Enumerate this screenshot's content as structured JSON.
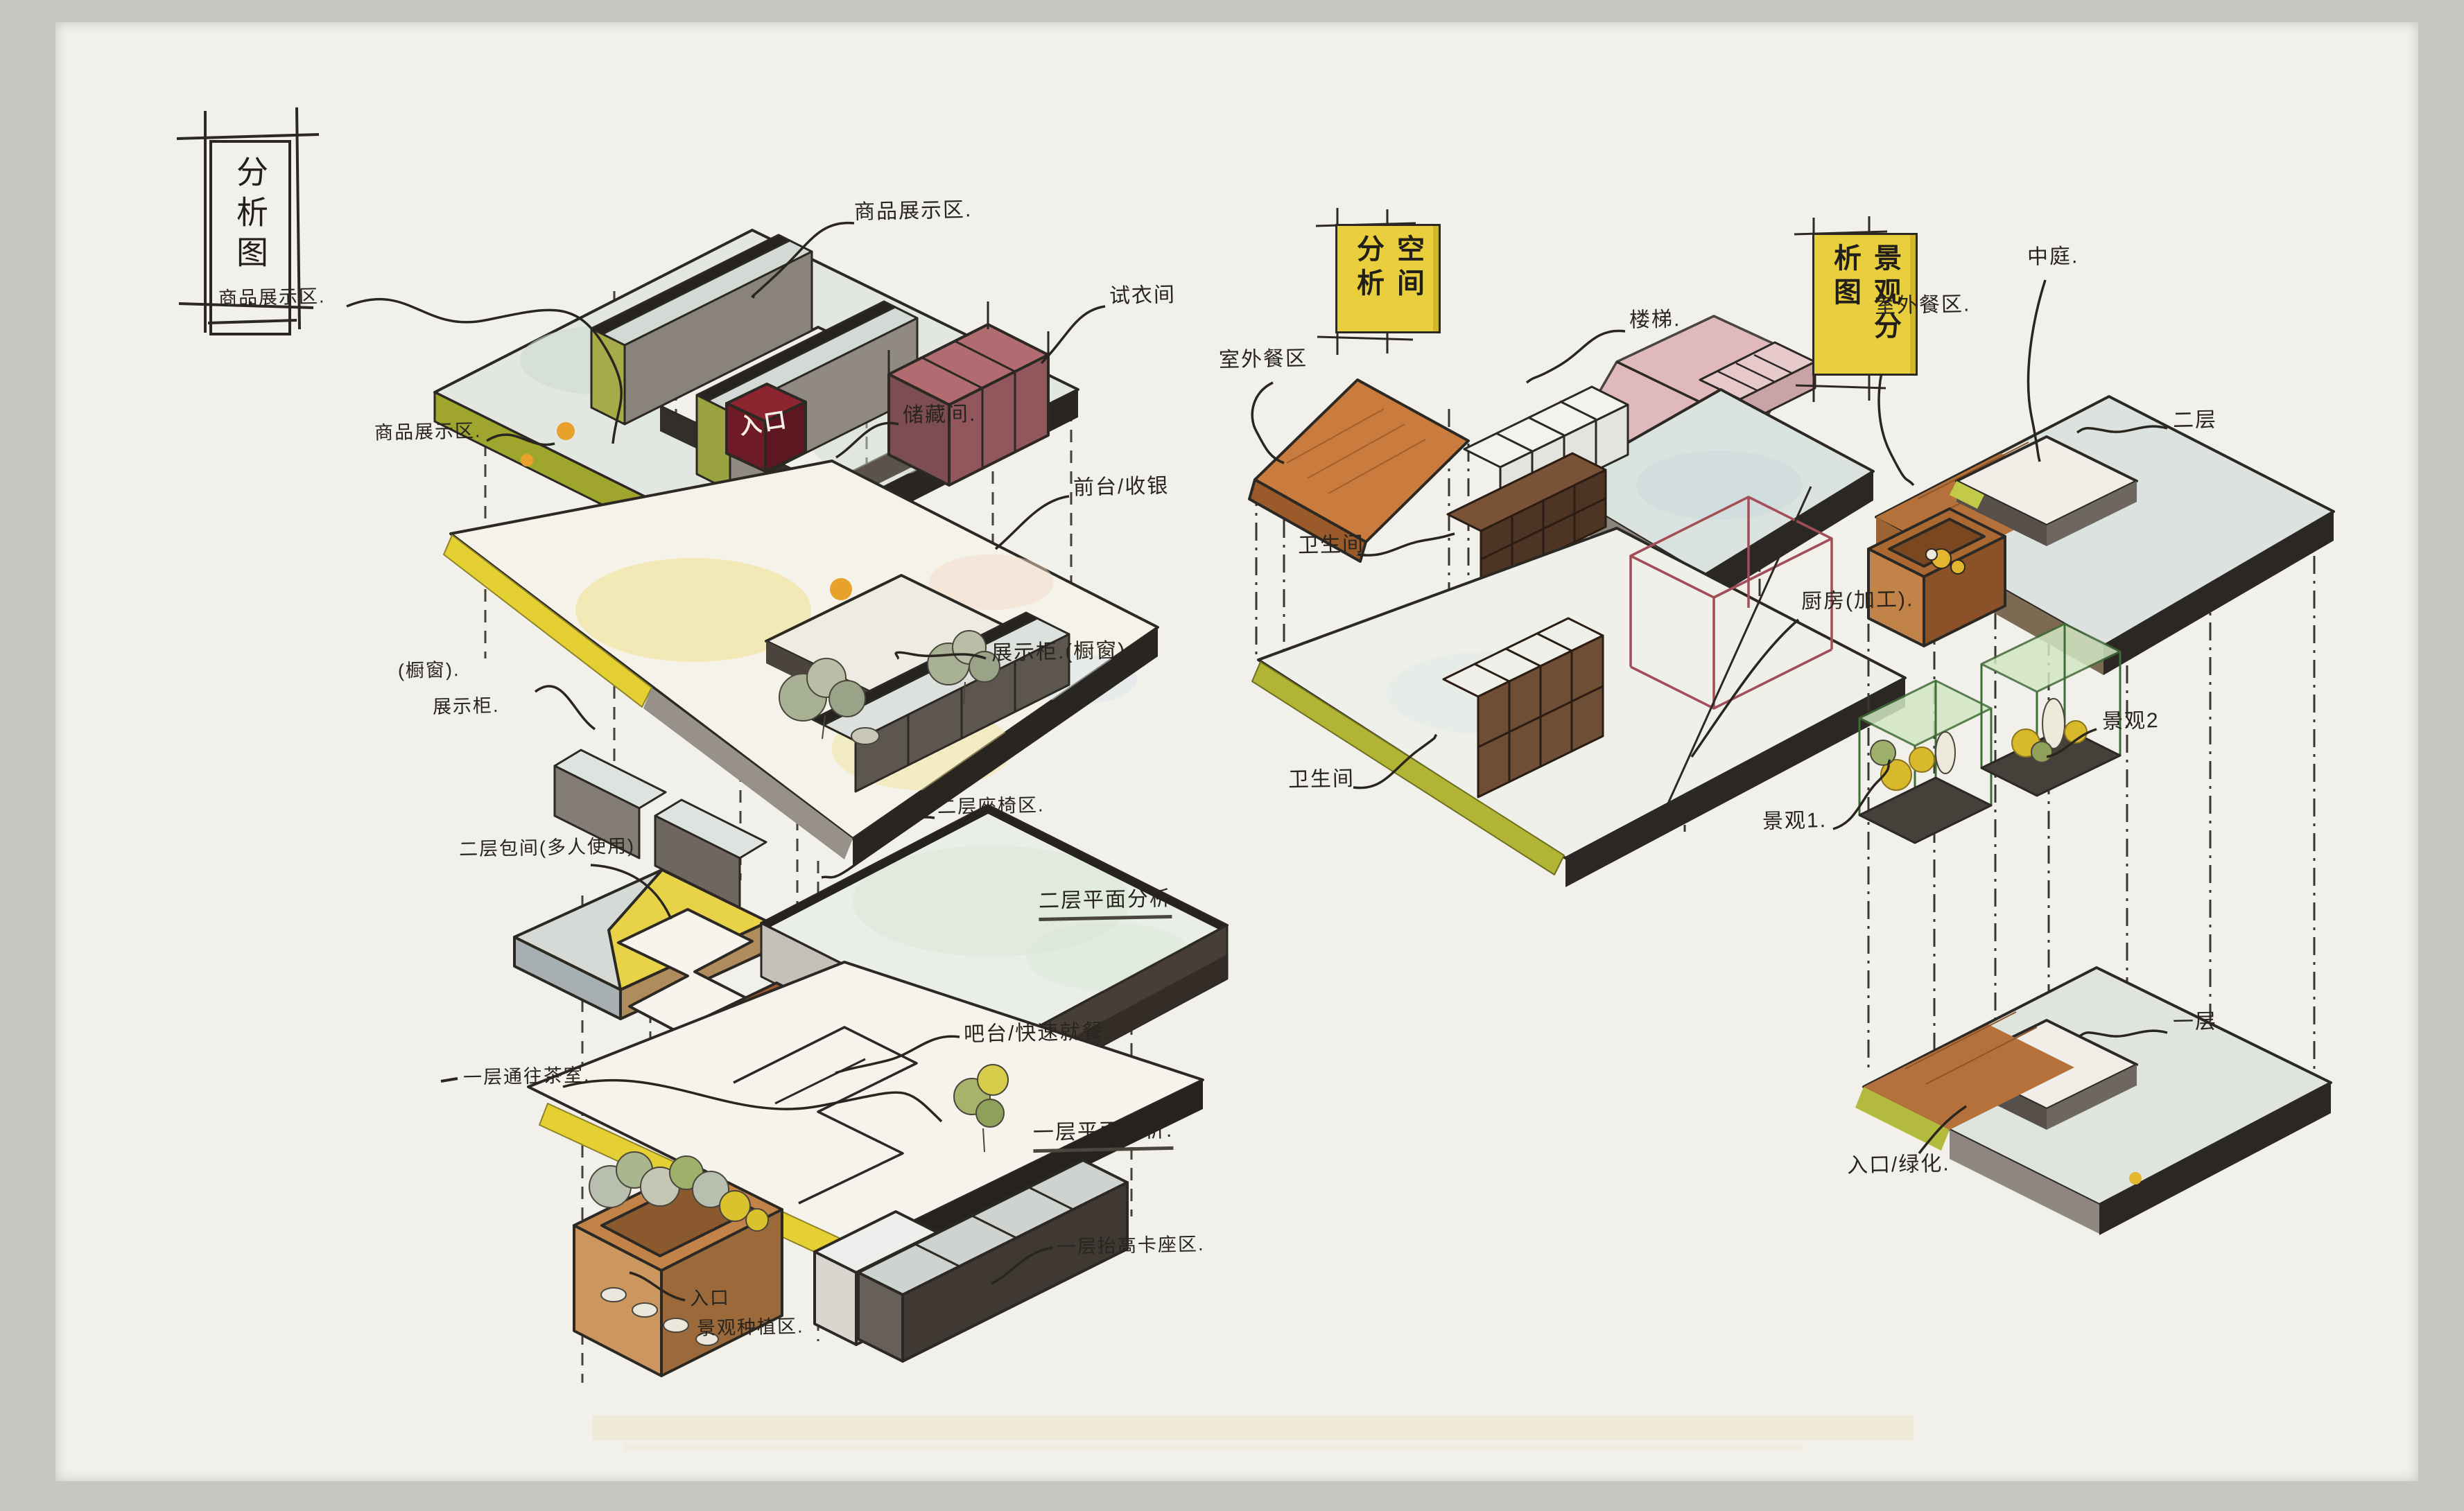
{
  "page": {
    "background": "#c9c7c3",
    "paper": "#f2f0eb",
    "highlight_band": "#ece5c2"
  },
  "palette": {
    "ink": "#2c2823",
    "slab_top_gray": "#e2e7e2",
    "slab_dark_edge": "#292521",
    "olive_edge": "#a0a52e",
    "yellow_strip": "#e5d033",
    "banner_yellow": "#e9cf3d",
    "wood_orange": "#c97c3e",
    "entrance_red": "#8d2531",
    "fitting_pink": "#b26b70",
    "stair_pink": "#ddb0b4",
    "glass_green": "#d2e7c4",
    "plant_yellow": "#d8b92c",
    "counter_brown": "#a05c31"
  },
  "title_box": {
    "label": "分析图."
  },
  "merchandise_diagram": {
    "labels": {
      "display_zone_a": "商品展示区.",
      "display_zone_b": "商品展示区.",
      "display_zone_c": "商品展示区.",
      "fitting_room": "试衣间",
      "storage_room": "储藏间.",
      "front_desk_cashier": "前台/收银",
      "entrance": "入口",
      "shop_window_paren": "(橱窗).",
      "display_cabinet_left": "展示柜.",
      "display_cabinet_right": "展示柜.(橱窗)."
    }
  },
  "floor_plan_diagram": {
    "labels": {
      "second_floor_room": "二层包间(多人使用)",
      "second_floor_seating": "二层座椅区.",
      "second_floor_plan_title": "二层平面分析",
      "bar_quick_dining": "吧台/快速就餐.",
      "first_floor_plan_title": "一层平面分析.",
      "first_floor_path": "一层通往茶室.",
      "entrance": "入口",
      "landscape_planting": "景观种植区.",
      "raised_booth_area": "一层抬高卡座区."
    }
  },
  "space_diagram": {
    "banner": "空间分析",
    "labels": {
      "outdoor_dining": "室外餐区",
      "stairs": "楼梯.",
      "restroom_upper": "卫生间",
      "kitchen_processing": "厨房(加工).",
      "restroom_lower": "卫生间"
    }
  },
  "landscape_diagram": {
    "banner": "景观分析图",
    "labels": {
      "outdoor_dining": "室外餐区.",
      "atrium": "中庭.",
      "second_floor": "二层",
      "landscape_2": "景观2",
      "landscape_1": "景观1.",
      "first_floor": "一层",
      "entrance_greening": "入口/绿化."
    }
  }
}
